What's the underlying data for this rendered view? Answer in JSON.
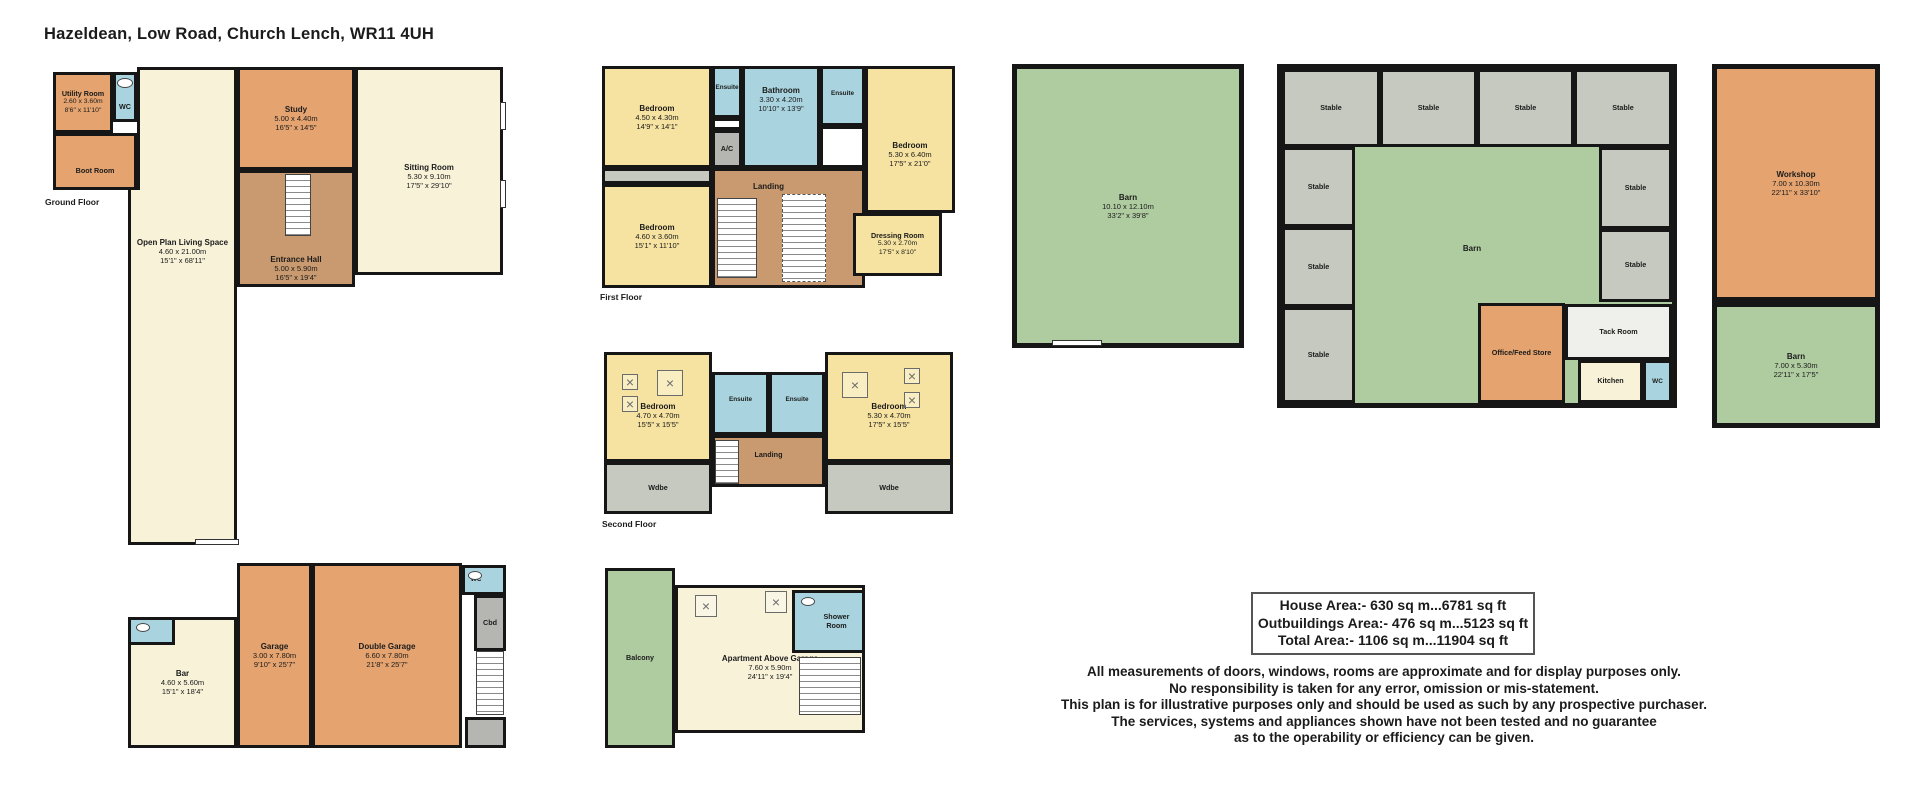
{
  "title": "Hazeldean, Low Road, Church Lench, WR11 4UH",
  "floors": {
    "ground": {
      "label": "Ground Floor",
      "rooms": [
        {
          "name": "Utility Room",
          "dims_m": "2.60 x 3.60m",
          "dims_ft": "8'6\" x 11'10\"",
          "color": "orange",
          "small": true,
          "x": 8,
          "y": 10,
          "w": 60,
          "h": 61
        },
        {
          "name": "WC",
          "color": "blue",
          "small": true,
          "x": 68,
          "y": 10,
          "w": 24,
          "h": 50,
          "ldy": 10
        },
        {
          "name": "Boot Room",
          "color": "orange",
          "small": true,
          "x": 8,
          "y": 71,
          "w": 84,
          "h": 57,
          "ldy": 10
        },
        {
          "name": "",
          "color": "cream",
          "x": 92,
          "y": 5,
          "w": 100,
          "h": 123,
          "bw": "3px 3px 0 3px"
        },
        {
          "name": "Open Plan Living Space",
          "dims_m": "4.60 x 21.00m",
          "dims_ft": "15'1\" x 68'11\"",
          "color": "cream",
          "x": 83,
          "y": 128,
          "w": 109,
          "h": 355,
          "bw": "0 3px 3px 3px",
          "ldy": -115
        },
        {
          "name": "Study",
          "dims_m": "5.00 x 4.40m",
          "dims_ft": "16'5\" x 14'5\"",
          "color": "orange",
          "x": 192,
          "y": 5,
          "w": 118,
          "h": 103
        },
        {
          "name": "Entrance Hall",
          "dims_m": "5.00 x 5.90m",
          "dims_ft": "16'5\" x 19'4\"",
          "color": "brown",
          "x": 192,
          "y": 108,
          "w": 118,
          "h": 117,
          "ldy": 40
        },
        {
          "name": "Sitting Room",
          "dims_m": "5.30 x 9.10m",
          "dims_ft": "17'5\" x 29'10\"",
          "color": "cream",
          "x": 310,
          "y": 5,
          "w": 148,
          "h": 208,
          "ldy": 5
        }
      ]
    },
    "first": {
      "label": "First Floor",
      "rooms": [
        {
          "name": "Bedroom",
          "dims_m": "4.50 x 4.30m",
          "dims_ft": "14'9\" x 14'1\"",
          "color": "yellow",
          "x": 0,
          "y": 0,
          "w": 110,
          "h": 102
        },
        {
          "name": "Ensuite",
          "color": "blue",
          "tiny": true,
          "x": 110,
          "y": 0,
          "w": 30,
          "h": 52,
          "ldy": -4
        },
        {
          "name": "",
          "color": "white",
          "x": 110,
          "y": 52,
          "w": 30,
          "h": 12
        },
        {
          "name": "A/C",
          "color": "dgray",
          "small": true,
          "x": 110,
          "y": 64,
          "w": 30,
          "h": 38
        },
        {
          "name": "Bathroom",
          "dims_m": "3.30 x 4.20m",
          "dims_ft": "10'10\" x 13'9\"",
          "color": "blue",
          "x": 140,
          "y": 0,
          "w": 78,
          "h": 102,
          "ldy": -18
        },
        {
          "name": "Ensuite",
          "color": "blue",
          "tiny": true,
          "x": 218,
          "y": 0,
          "w": 45,
          "h": 60,
          "ldy": -2
        },
        {
          "name": "",
          "color": "white",
          "x": 218,
          "y": 60,
          "w": 45,
          "h": 42
        },
        {
          "name": "Bedroom",
          "dims_m": "5.30 x 6.40m",
          "dims_ft": "17'5\" x 21'0\"",
          "color": "yellow",
          "x": 263,
          "y": 0,
          "w": 90,
          "h": 147,
          "ldy": 15
        },
        {
          "name": "",
          "color": "gray",
          "x": 0,
          "y": 102,
          "w": 110,
          "h": 16
        },
        {
          "name": "Bedroom",
          "dims_m": "4.60 x 3.60m",
          "dims_ft": "15'1\" x 11'10\"",
          "color": "yellow",
          "x": 0,
          "y": 118,
          "w": 110,
          "h": 104
        },
        {
          "name": "Landing",
          "color": "brown",
          "x": 110,
          "y": 102,
          "w": 153,
          "h": 120,
          "ldx": -20,
          "ldy": -42
        },
        {
          "name": "Dressing Room",
          "dims_m": "5.30 x 2.70m",
          "dims_ft": "17'5\" x 8'10\"",
          "color": "yellow",
          "small": true,
          "x": 251,
          "y": 147,
          "w": 89,
          "h": 63
        }
      ]
    },
    "second": {
      "label": "Second Floor",
      "rooms": [
        {
          "name": "Bedroom",
          "dims_m": "4.70 x 4.70m",
          "dims_ft": "15'5\" x 15'5\"",
          "color": "yellow",
          "x": 2,
          "y": 0,
          "w": 108,
          "h": 110,
          "ldy": 8
        },
        {
          "name": "Wdbe",
          "color": "gray",
          "small": true,
          "x": 2,
          "y": 110,
          "w": 108,
          "h": 52
        },
        {
          "name": "Ensuite",
          "color": "blue",
          "tiny": true,
          "x": 110,
          "y": 20,
          "w": 57,
          "h": 63,
          "ldy": -4
        },
        {
          "name": "Ensuite",
          "color": "blue",
          "tiny": true,
          "x": 167,
          "y": 20,
          "w": 56,
          "h": 63,
          "ldy": -4
        },
        {
          "name": "Landing",
          "color": "brown",
          "small": true,
          "x": 110,
          "y": 83,
          "w": 113,
          "h": 52,
          "ldy": -6
        },
        {
          "name": "Bedroom",
          "dims_m": "5.30 x 4.70m",
          "dims_ft": "17'5\" x 15'5\"",
          "color": "yellow",
          "x": 223,
          "y": 0,
          "w": 128,
          "h": 110,
          "ldy": 8
        },
        {
          "name": "Wdbe",
          "color": "gray",
          "small": true,
          "x": 223,
          "y": 110,
          "w": 128,
          "h": 52
        }
      ]
    },
    "garage": {
      "rooms": [
        {
          "name": "Bar",
          "dims_m": "4.60 x 5.60m",
          "dims_ft": "15'1\" x 18'4\"",
          "color": "cream",
          "x": 0,
          "y": 54,
          "w": 109,
          "h": 131
        },
        {
          "name": "",
          "color": "blue",
          "x": 0,
          "y": 54,
          "w": 47,
          "h": 28
        },
        {
          "name": "Garage",
          "dims_m": "3.00 x 7.80m",
          "dims_ft": "9'10\" x 25'7\"",
          "color": "orange",
          "x": 109,
          "y": 0,
          "w": 75,
          "h": 185
        },
        {
          "name": "Double Garage",
          "dims_m": "6.60 x 7.80m",
          "dims_ft": "21'8\" x 25'7\"",
          "color": "orange",
          "x": 184,
          "y": 0,
          "w": 150,
          "h": 185
        },
        {
          "name": "WC",
          "color": "blue",
          "tiny": true,
          "x": 334,
          "y": 2,
          "w": 44,
          "h": 30,
          "ldx": -8
        },
        {
          "name": "Cbd",
          "color": "dgray",
          "small": true,
          "x": 346,
          "y": 32,
          "w": 32,
          "h": 56
        },
        {
          "name": "",
          "color": "dgray",
          "x": 337,
          "y": 154,
          "w": 41,
          "h": 31
        }
      ]
    },
    "apartment": {
      "rooms": [
        {
          "name": "Balcony",
          "color": "green",
          "small": true,
          "x": 0,
          "y": 5,
          "w": 70,
          "h": 180
        },
        {
          "name": "Apartment Above Garage",
          "dims_m": "7.60 x 5.90m",
          "dims_ft": "24'11\" x 19'4\"",
          "color": "cream",
          "x": 70,
          "y": 22,
          "w": 190,
          "h": 148,
          "ldy": 8
        },
        {
          "name": "Shower\nRoom",
          "color": "blue",
          "small": true,
          "x": 187,
          "y": 27,
          "w": 73,
          "h": 63,
          "ldx": 8
        }
      ]
    },
    "barn": {
      "rooms": [
        {
          "name": "Barn",
          "dims_m": "10.10 x 12.10m",
          "dims_ft": "33'2\" x 39'8\"",
          "color": "green",
          "x": 0,
          "y": 0,
          "w": 232,
          "h": 284,
          "bw": "5px"
        }
      ]
    },
    "stables": {
      "rooms": [
        {
          "name": "Stable",
          "color": "gray",
          "small": true,
          "x": 0,
          "y": 0,
          "w": 98,
          "h": 78
        },
        {
          "name": "Stable",
          "color": "gray",
          "small": true,
          "x": 98,
          "y": 0,
          "w": 97,
          "h": 78
        },
        {
          "name": "Stable",
          "color": "gray",
          "small": true,
          "x": 195,
          "y": 0,
          "w": 97,
          "h": 78
        },
        {
          "name": "Stable",
          "color": "gray",
          "small": true,
          "x": 292,
          "y": 0,
          "w": 98,
          "h": 78
        },
        {
          "name": "Stable",
          "color": "gray",
          "small": true,
          "x": 0,
          "y": 78,
          "w": 73,
          "h": 80
        },
        {
          "name": "Stable",
          "color": "gray",
          "small": true,
          "x": 0,
          "y": 158,
          "w": 73,
          "h": 80
        },
        {
          "name": "Stable",
          "color": "gray",
          "small": true,
          "x": 0,
          "y": 238,
          "w": 73,
          "h": 96
        },
        {
          "name": "Stable",
          "color": "gray",
          "small": true,
          "x": 317,
          "y": 78,
          "w": 73,
          "h": 82
        },
        {
          "name": "Stable",
          "color": "gray",
          "small": true,
          "x": 317,
          "y": 160,
          "w": 73,
          "h": 73
        },
        {
          "name": "Barn",
          "color": "none",
          "x": 145,
          "y": 168,
          "w": 90,
          "h": 22,
          "bw": "0"
        },
        {
          "name": "Office/Feed Store",
          "color": "orange",
          "small": true,
          "x": 196,
          "y": 234,
          "w": 87,
          "h": 100
        },
        {
          "name": "Tack Room",
          "color": "tack",
          "small": true,
          "x": 283,
          "y": 235,
          "w": 107,
          "h": 56
        },
        {
          "name": "Kitchen",
          "color": "cream",
          "small": true,
          "x": 296,
          "y": 291,
          "w": 65,
          "h": 43
        },
        {
          "name": "WC",
          "color": "blue",
          "tiny": true,
          "x": 361,
          "y": 291,
          "w": 29,
          "h": 43
        }
      ]
    },
    "workshop": {
      "rooms": [
        {
          "name": "Workshop",
          "dims_m": "7.00 x 10.30m",
          "dims_ft": "22'11\" x 33'10\"",
          "color": "orange",
          "x": 0,
          "y": 0,
          "w": 168,
          "h": 238,
          "bw": "5px"
        },
        {
          "name": "Barn",
          "dims_m": "7.00 x 5.30m",
          "dims_ft": "22'11\" x 17'5\"",
          "color": "green",
          "x": 0,
          "y": 238,
          "w": 168,
          "h": 126,
          "bw": "5px"
        }
      ]
    }
  },
  "area_summary": {
    "lines": [
      "House Area:- 630 sq m...6781 sq ft",
      "Outbuildings Area:- 476 sq m...5123 sq ft",
      "Total Area:- 1106 sq m...11904 sq ft"
    ]
  },
  "disclaimer": {
    "lines": [
      "All measurements of doors, windows, rooms are approximate and for display purposes only.",
      "No responsibility is taken for any error, omission or mis-statement.",
      "This plan is for illustrative purposes only and should be used as such by any prospective purchaser.",
      "The services, systems and appliances shown have not been tested and no guarantee",
      "as to the operability or efficiency can be given."
    ]
  },
  "colors": {
    "wall": "#161616",
    "orange": "#E4A36F",
    "cream": "#F7F2D8",
    "yellow": "#F6E3A1",
    "blue": "#A9D4DF",
    "brown": "#C99A6F",
    "green": "#AFCBA0",
    "gray": "#C6C9C0"
  }
}
